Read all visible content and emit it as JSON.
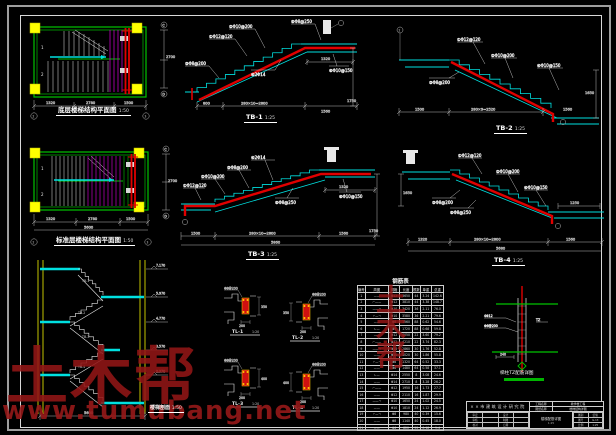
{
  "watermark": {
    "brand": "土木帮",
    "url": "www.tumubang.net",
    "stamp": "土木帮"
  },
  "plan1": {
    "title": "底层楼梯结构平面图",
    "scale": "1:50",
    "flight1": "1",
    "flight2": "2",
    "dims": [
      "1320",
      "2780",
      "1500"
    ],
    "total": "5600",
    "dim_right": "2700",
    "axis_b1": "2",
    "axis_b2": "3",
    "axis_r1": "C",
    "axis_r2": "D"
  },
  "plan2": {
    "title": "标准层楼梯结构平面图",
    "scale": "1:50",
    "flight1": "1",
    "flight2": "2",
    "dims": [
      "1320",
      "2780",
      "1500"
    ],
    "total": "5600",
    "dim_right": "2700",
    "axis_b1": "2",
    "axis_b2": "3",
    "axis_r1": "C",
    "axis_r2": "D"
  },
  "elevation": {
    "label": "楼梯剖面",
    "scale": "1:50",
    "flights": [
      "TB-1",
      "TB-2",
      "TB-3",
      "TB-4"
    ],
    "levels": [
      "7.170",
      "5.970",
      "4.770",
      "3.570",
      "2.370"
    ],
    "total": "5600"
  },
  "tb1": {
    "label": "TB-1",
    "scale": "1:25",
    "callouts": [
      "①Φ12@120",
      "②Φ10@200",
      "③Φ8@200",
      "④2Φ14",
      "⑤Φ8@250",
      "⑥Φ10@150"
    ],
    "dims": [
      "800",
      "280×10=2800",
      "1560"
    ],
    "dim_right": "1750",
    "dim_top": "1320"
  },
  "tb2": {
    "label": "TB-2",
    "scale": "1:25",
    "axis": "2",
    "callouts": [
      "①Φ12@120",
      "②Φ10@200",
      "③Φ8@200",
      "④Φ10@150"
    ],
    "dims": [
      "1500",
      "280×9=2520",
      "1560"
    ],
    "dim_right": "1650"
  },
  "tb3": {
    "label": "TB-3",
    "scale": "1:25",
    "callouts": [
      "①Φ12@120",
      "②Φ10@200",
      "③Φ8@200",
      "④2Φ14",
      "⑤Φ8@250",
      "⑥Φ10@150"
    ],
    "dims": [
      "1500",
      "280×10=2800",
      "1560"
    ],
    "total": "5860",
    "dim_right": "1750",
    "dim_top": "1320"
  },
  "tb4": {
    "label": "TB-4",
    "scale": "1:25",
    "callouts": [
      "①Φ12@120",
      "②Φ10@200",
      "③Φ8@200",
      "④Φ10@150",
      "⑤Φ8@250"
    ],
    "dims": [
      "1320",
      "280×10=2800",
      "1560"
    ],
    "total": "5680",
    "dim_left": "1650",
    "dim_top": "1250"
  },
  "tl1": {
    "label": "TL-1",
    "scale": "1:20",
    "callout": "Φ8@200",
    "dim_w": "200",
    "dim_h": "350"
  },
  "tl2": {
    "label": "TL-2",
    "scale": "1:20",
    "callout": "Φ8@200",
    "dim_w": "200",
    "dim_h": "350"
  },
  "tl3": {
    "label": "TL-3",
    "scale": "1:20",
    "callout": "Φ8@200",
    "dim_w": "200",
    "dim_h": "400"
  },
  "tl4": {
    "label": "TL-4",
    "scale": "1:20",
    "callout": "Φ8@200",
    "dim_w": "200",
    "dim_h": "400"
  },
  "node": {
    "label": "梯柱TZ配筋详图",
    "c1": "4Φ12",
    "c2": "Φ6@200",
    "c3": "TZ",
    "dim": "240"
  },
  "table": {
    "title": "钢筋表",
    "headers": [
      "编号",
      "简图",
      "规格",
      "长度",
      "根数",
      "单重",
      "总重"
    ],
    "rows": [
      [
        "1",
        "——",
        "Φ12",
        "3650",
        "44",
        "3.24",
        "142.6"
      ],
      [
        "2",
        "⌐——",
        "Φ12",
        "3810",
        "44",
        "3.38",
        "148.7"
      ],
      [
        "3",
        "——¬",
        "Φ10",
        "3420",
        "36",
        "2.11",
        "76.0"
      ],
      [
        "4",
        "⌐—¬",
        "Φ10",
        "3580",
        "36",
        "2.21",
        "79.6"
      ],
      [
        "5",
        "——",
        "Φ8",
        "1560",
        "88",
        "0.62",
        "54.6"
      ],
      [
        "6",
        "∟—",
        "Φ8",
        "1720",
        "88",
        "0.68",
        "59.8"
      ],
      [
        "7",
        "——",
        "Φ12",
        "4050",
        "22",
        "3.60",
        "79.2"
      ],
      [
        "8",
        "⌐——",
        "Φ12",
        "4210",
        "22",
        "3.74",
        "82.3"
      ],
      [
        "9",
        "——¬",
        "Φ10",
        "2860",
        "30",
        "1.76",
        "52.8"
      ],
      [
        "10",
        "——",
        "Φ10",
        "3020",
        "30",
        "1.86",
        "55.8"
      ],
      [
        "11",
        "⌐—¬",
        "Φ8",
        "1320",
        "64",
        "0.52",
        "33.3"
      ],
      [
        "12",
        "——",
        "Φ8",
        "1480",
        "64",
        "0.58",
        "37.1"
      ],
      [
        "13",
        "∟—",
        "Φ14",
        "2550",
        "8",
        "3.08",
        "24.6"
      ],
      [
        "14",
        "——",
        "Φ14",
        "2710",
        "8",
        "3.28",
        "26.2"
      ],
      [
        "15",
        "⌐——",
        "Φ12",
        "1950",
        "16",
        "1.73",
        "27.7"
      ],
      [
        "16",
        "——",
        "Φ12",
        "2110",
        "16",
        "1.87",
        "29.9"
      ],
      [
        "17",
        "——¬",
        "Φ10",
        "1650",
        "24",
        "1.02",
        "24.5"
      ],
      [
        "18",
        "——",
        "Φ10",
        "1810",
        "24",
        "1.12",
        "26.9"
      ],
      [
        "19",
        "⌐—¬",
        "Φ8",
        "980",
        "40",
        "0.39",
        "15.6"
      ],
      [
        "20",
        "——",
        "Φ8",
        "1140",
        "40",
        "0.45",
        "18.0"
      ],
      [
        "21",
        "∟—",
        "Φ6",
        "820",
        "52",
        "0.18",
        "9.4"
      ]
    ]
  },
  "titleblock": {
    "institute": "××市建筑设计研究院",
    "fields": [
      {
        "label": "工程名称",
        "value": "教学楼工程"
      },
      {
        "label": "图纸名称",
        "value": "楼梯结构详图"
      }
    ],
    "left_rows": [
      [
        "审定",
        "",
        "设计",
        ""
      ],
      [
        "审核",
        "",
        "制图",
        ""
      ],
      [
        "校对",
        "",
        "日期",
        ""
      ]
    ],
    "mid_title": "楼梯配筋详图",
    "mid_scale": "1:25",
    "right_rows": [
      [
        "图别",
        "结施"
      ],
      [
        "图号",
        "G-13"
      ],
      [
        "比例",
        "1:25"
      ]
    ]
  }
}
